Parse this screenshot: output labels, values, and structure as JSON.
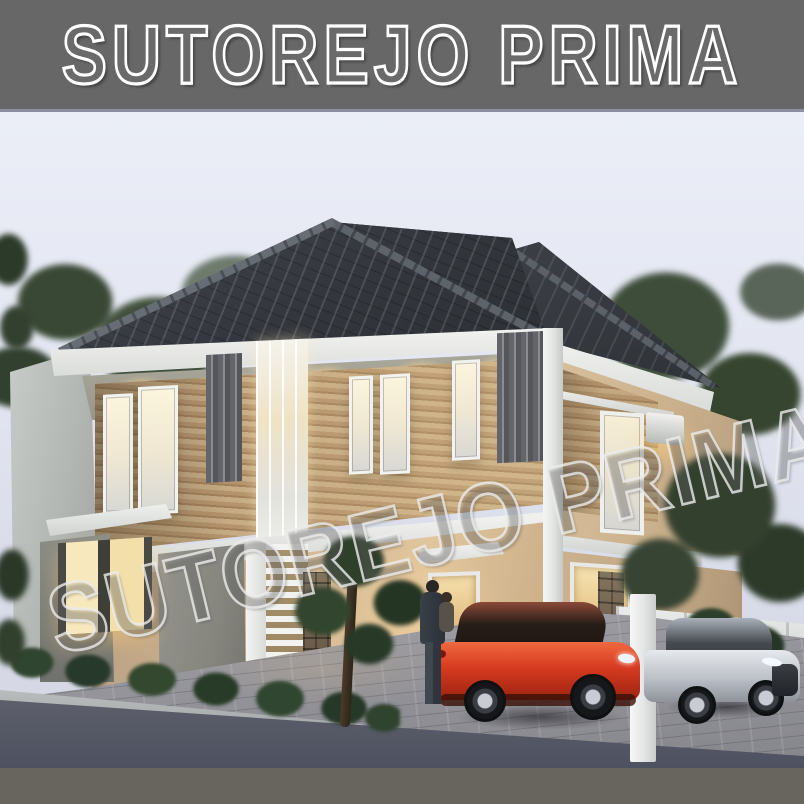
{
  "title_bar": {
    "text": "SUTOREJO PRIMA"
  },
  "watermark": {
    "text": "SUTOREJO PRIMA"
  },
  "scene": {
    "description_labels": {
      "left_house_unit": "two-story modern house, dusk render",
      "right_house_unit": "adjacent twin unit",
      "vehicles": [
        "red sports sedan",
        "silver compact SUV"
      ],
      "people": [
        "man holding child"
      ]
    },
    "colors": {
      "frame_gray": "#676767",
      "footer_gray": "#67655e",
      "sky_top": "#ebeef7",
      "sky_bottom": "#d3d6e2",
      "roof_dark": "#33363c",
      "fascia_white": "#f3f4f2",
      "soffit_olive": "#a3a295",
      "wood_panel": "#b4946c",
      "wall_beige": "#d3b995",
      "wall_gray": "#86867f",
      "boundary_wall": "#b2b6b3",
      "window_warm": "#f7eed6",
      "downlight_warm": "#ffd88e",
      "foliage_green": "#3c4b39",
      "shrub_green": "#2e4230",
      "paver_gray": "#909096",
      "asphalt_gray": "#595c68",
      "fence_white": "#e9ebea",
      "stone_brown": "#6e5f4c",
      "car_red": "#d63a20",
      "car_silver": "#bcc0c7"
    }
  }
}
